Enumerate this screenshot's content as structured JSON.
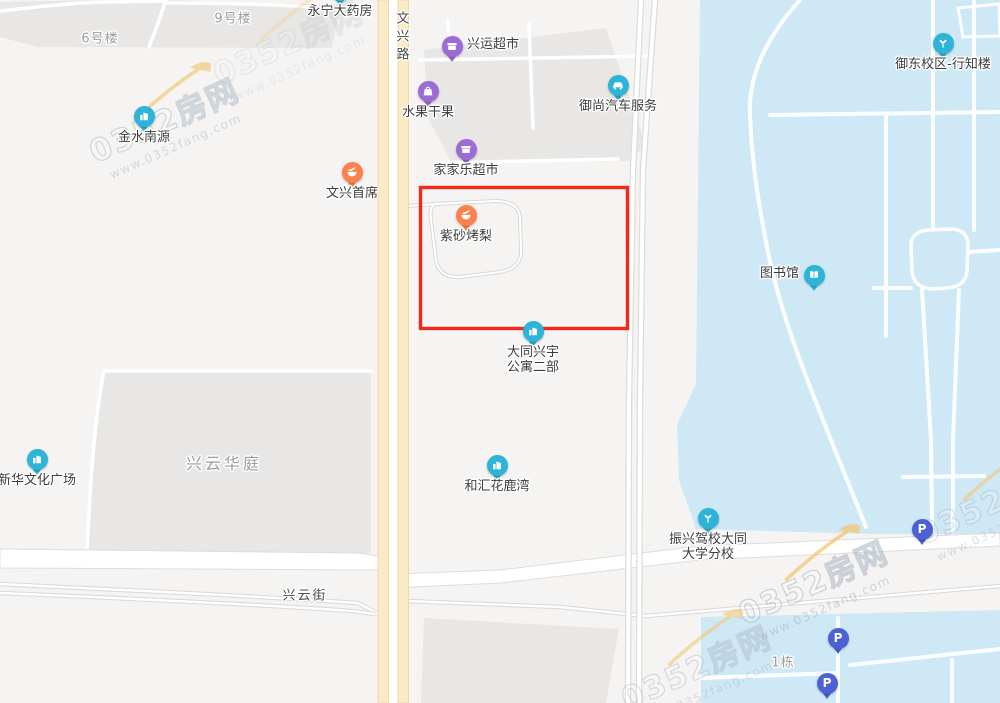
{
  "map": {
    "colors": {
      "background": "#f5f4f2",
      "block_gray": "#e8e7e5",
      "water_blue": "#cfe8f6",
      "road_yellow": "#fbeac6",
      "road_yellow_border": "#eed9a9",
      "road_white": "#ffffff",
      "road_border": "#dedddb",
      "highlight_red": "#ee2a1a",
      "pin_purple": "#9c6bd3",
      "pin_teal": "#2db4d8",
      "pin_orange": "#f9824d",
      "pin_parking": "#4c61d3"
    },
    "highlight_box": {
      "x": 420.5,
      "y": 187.5,
      "width": 207,
      "height": 141
    },
    "road_labels": [
      {
        "text": "文兴路",
        "x": 401,
        "y": 38,
        "vertical": true
      },
      {
        "text": "兴云街",
        "x": 305,
        "y": 594,
        "vertical": false
      }
    ],
    "area_labels": [
      {
        "text": "9号楼",
        "x": 233,
        "y": 17,
        "size": 13,
        "spacing": 1
      },
      {
        "text": "6号楼",
        "x": 100,
        "y": 37,
        "size": 13,
        "spacing": 1
      },
      {
        "text": "兴云华庭",
        "x": 224,
        "y": 462,
        "size": 16,
        "spacing": 3
      },
      {
        "text": "1栋",
        "x": 783,
        "y": 661,
        "size": 13,
        "spacing": 1
      }
    ],
    "markers": [
      {
        "id": "yongning-pharmacy",
        "label": "永宁大药房",
        "label2": "",
        "icon": "cross-icon",
        "color": "pin_teal",
        "x": 340,
        "y": -10,
        "side": "bottom"
      },
      {
        "id": "xingyun-supermarket",
        "label": "兴运超市",
        "label2": "",
        "icon": "store-icon",
        "color": "pin_purple",
        "x": 452,
        "y": 46,
        "side": "right"
      },
      {
        "id": "shuiguo-ganguo",
        "label": "水果干果",
        "label2": "",
        "icon": "bag-icon",
        "color": "pin_purple",
        "x": 428,
        "y": 91,
        "side": "bottom"
      },
      {
        "id": "yushang-auto-service",
        "label": "御尚汽车服务",
        "label2": "",
        "icon": "car-icon",
        "color": "pin_teal",
        "x": 618,
        "y": 85,
        "side": "bottom"
      },
      {
        "id": "jiajiale-supermarket",
        "label": "家家乐超市",
        "label2": "",
        "icon": "store-icon",
        "color": "pin_purple",
        "x": 466,
        "y": 149,
        "side": "bottom"
      },
      {
        "id": "wenxing-shouxi",
        "label": "文兴首席",
        "label2": "",
        "icon": "food-icon",
        "color": "pin_orange",
        "x": 352,
        "y": 172,
        "side": "bottom"
      },
      {
        "id": "zisha-kaoli",
        "label": "紫砂烤梨",
        "label2": "",
        "icon": "food-icon",
        "color": "pin_orange",
        "x": 466,
        "y": 215,
        "side": "bottom"
      },
      {
        "id": "jinshui-nanyuan",
        "label": "金水南源",
        "label2": "",
        "icon": "building-icon",
        "color": "pin_teal",
        "x": 144,
        "y": 116,
        "side": "bottom"
      },
      {
        "id": "datong-xingyu-apartment",
        "label": "大同兴宇",
        "label2": "公寓二部",
        "icon": "building-icon",
        "color": "pin_teal",
        "x": 533,
        "y": 331,
        "side": "bottom"
      },
      {
        "id": "library",
        "label": "图书馆",
        "label2": "",
        "icon": "book-icon",
        "color": "pin_teal",
        "x": 814,
        "y": 275,
        "side": "left"
      },
      {
        "id": "yudong-campus-xingzhilou",
        "label": "御东校区-行知楼",
        "label2": "",
        "icon": "sprout-icon",
        "color": "pin_teal",
        "x": 943,
        "y": 43,
        "side": "bottom"
      },
      {
        "id": "xinhua-culture-plaza",
        "label": "新华文化广场",
        "label2": "",
        "icon": "building-icon",
        "color": "pin_teal",
        "x": 37,
        "y": 459,
        "side": "bottom"
      },
      {
        "id": "hehui-hualuwan",
        "label": "和汇花鹿湾",
        "label2": "",
        "icon": "building-icon",
        "color": "pin_teal",
        "x": 497,
        "y": 465,
        "side": "bottom"
      },
      {
        "id": "zhenxing-driving-school",
        "label": "振兴驾校大同",
        "label2": "大学分校",
        "icon": "sprout-icon",
        "color": "pin_teal",
        "x": 708,
        "y": 518,
        "side": "bottom"
      },
      {
        "id": "parking-1",
        "label": "",
        "label2": "",
        "icon": "parking-icon",
        "color": "pin_parking",
        "x": 922,
        "y": 529,
        "side": "bottom"
      },
      {
        "id": "parking-2",
        "label": "",
        "label2": "",
        "icon": "parking-icon",
        "color": "pin_parking",
        "x": 838,
        "y": 638,
        "side": "bottom"
      },
      {
        "id": "parking-3",
        "label": "",
        "label2": "",
        "icon": "parking-icon",
        "color": "pin_parking",
        "x": 827,
        "y": 683,
        "side": "bottom"
      }
    ],
    "watermark": {
      "brand": "0352房网",
      "url": "www.0352fang.com",
      "instances": [
        {
          "x": 163,
          "y": 118,
          "opacity": 0.75
        },
        {
          "x": 287,
          "y": 40,
          "opacity": 0.35
        },
        {
          "x": 812,
          "y": 580,
          "opacity": 0.85
        },
        {
          "x": 695,
          "y": 665,
          "opacity": 0.65
        },
        {
          "x": 990,
          "y": 500,
          "opacity": 0.65
        }
      ]
    }
  }
}
